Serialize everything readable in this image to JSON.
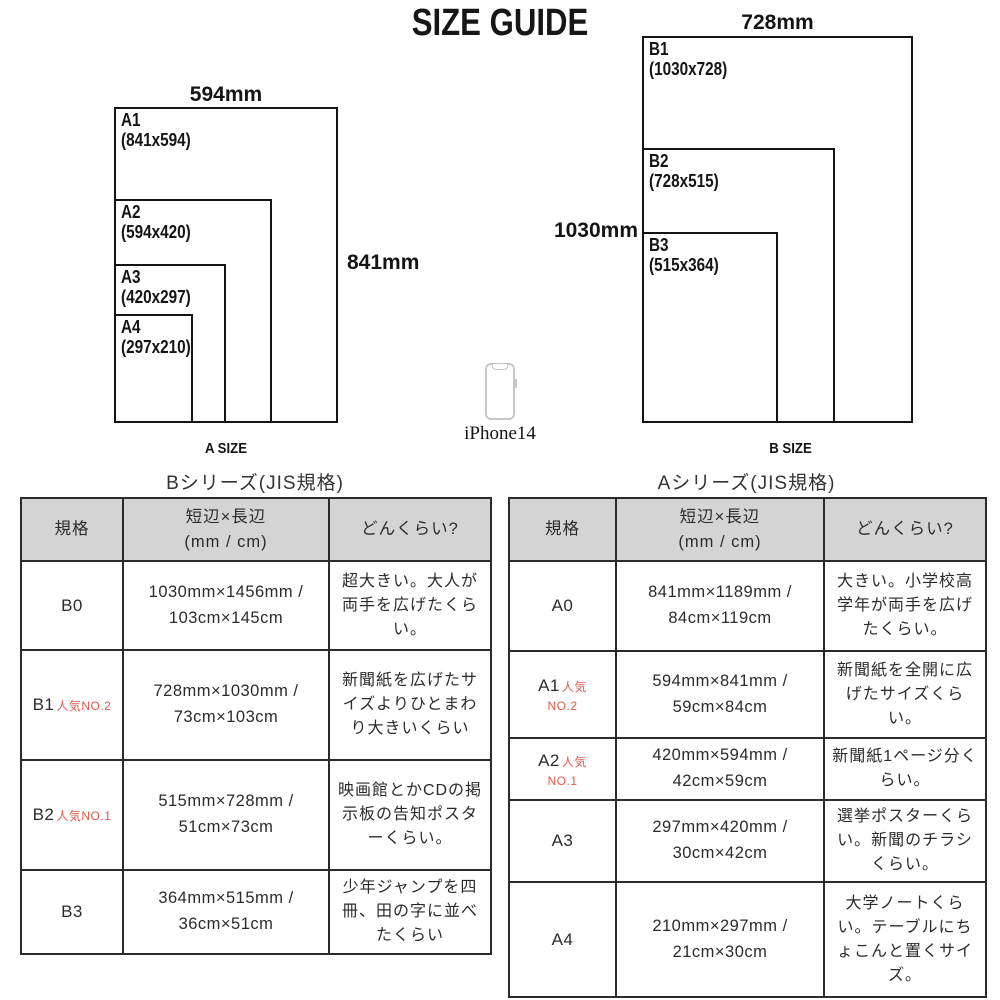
{
  "title": "SIZE GUIDE",
  "diagrams": {
    "a": {
      "top_dim": "594mm",
      "side_dim": "841mm",
      "caption": "A SIZE",
      "rects": [
        {
          "name": "A1",
          "dims": "(841x594)"
        },
        {
          "name": "A2",
          "dims": "(594x420)"
        },
        {
          "name": "A3",
          "dims": "(420x297)"
        },
        {
          "name": "A4",
          "dims": "(297x210)"
        }
      ]
    },
    "b": {
      "top_dim": "728mm",
      "side_dim": "1030mm",
      "caption": "B SIZE",
      "rects": [
        {
          "name": "B1",
          "dims": "(1030x728)"
        },
        {
          "name": "B2",
          "dims": "(728x515)"
        },
        {
          "name": "B3",
          "dims": "(515x364)"
        }
      ]
    },
    "phone_label": "iPhone14"
  },
  "tables": {
    "b": {
      "title": "Bシリーズ(JIS規格)",
      "headers": {
        "col1": "規格",
        "col2a": "短辺×長辺",
        "col2b": "(mm / cm)",
        "col3": "どんくらい?"
      },
      "rows": [
        {
          "size": "B0",
          "dims": "1030mm×1456mm / 103cm×145cm",
          "desc": "超大きい。大人が両手を広げたくらい。"
        },
        {
          "size": "B1",
          "badge1": "人気NO.2",
          "dims": "728mm×1030mm / 73cm×103cm",
          "desc": "新聞紙を広げたサイズよりひとまわり大きいくらい"
        },
        {
          "size": "B2",
          "badge1": "人気NO.1",
          "dims": "515mm×728mm / 51cm×73cm",
          "desc": "映画館とかCDの掲示板の告知ポスターくらい。"
        },
        {
          "size": "B3",
          "dims": "364mm×515mm / 36cm×51cm",
          "desc": "少年ジャンプを四冊、田の字に並べたくらい"
        }
      ]
    },
    "a": {
      "title": "Aシリーズ(JIS規格)",
      "headers": {
        "col1": "規格",
        "col2a": "短辺×長辺",
        "col2b": "(mm / cm)",
        "col3": "どんくらい?"
      },
      "rows": [
        {
          "size": "A0",
          "dims": "841mm×1189mm / 84cm×119cm",
          "desc": "大きい。小学校高学年が両手を広げたくらい。"
        },
        {
          "size": "A1",
          "badge1": "人気",
          "badge2": "NO.2",
          "dims": "594mm×841mm / 59cm×84cm",
          "desc": "新聞紙を全開に広げたサイズくらい。"
        },
        {
          "size": "A2",
          "badge1": "人気",
          "badge2": "NO.1",
          "dims": "420mm×594mm / 42cm×59cm",
          "desc": "新聞紙1ページ分くらい。"
        },
        {
          "size": "A3",
          "dims": "297mm×420mm / 30cm×42cm",
          "desc": "選挙ポスターくらい。新聞のチラシくらい。"
        },
        {
          "size": "A4",
          "dims": "210mm×297mm / 21cm×30cm",
          "desc": "大学ノートくらい。テーブルにちょこんと置くサイズ。"
        }
      ]
    }
  },
  "colors": {
    "badge_red": "#e05a4e",
    "header_gray": "#d4d4d4",
    "line_black": "#141414"
  }
}
